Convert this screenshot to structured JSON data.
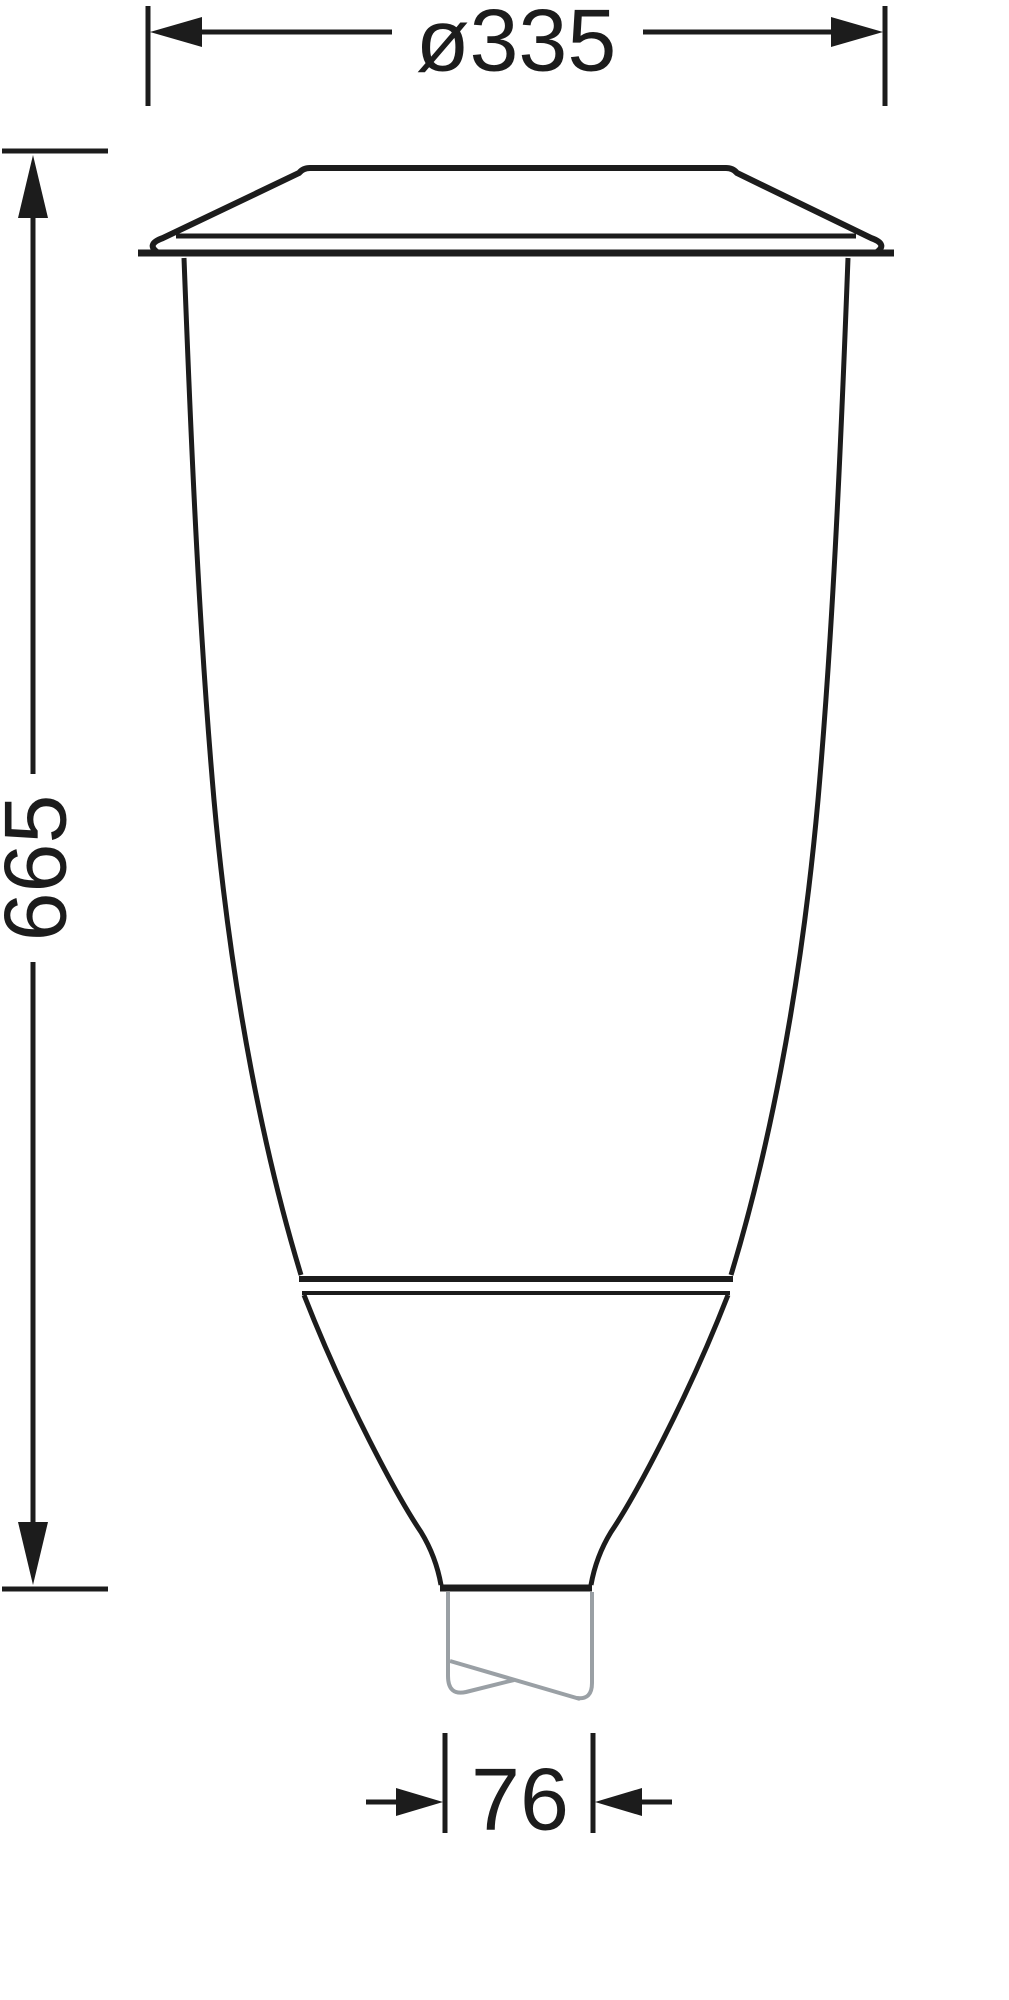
{
  "drawing": {
    "type": "technical-dimension-drawing",
    "line_color": "#1c1c1c",
    "pole_color": "#9aa0a5",
    "background_color": "#ffffff",
    "dimensions": {
      "top_diameter": {
        "label": "ø335"
      },
      "overall_height": {
        "label": "665"
      },
      "spigot_width": {
        "label": "76"
      }
    }
  }
}
